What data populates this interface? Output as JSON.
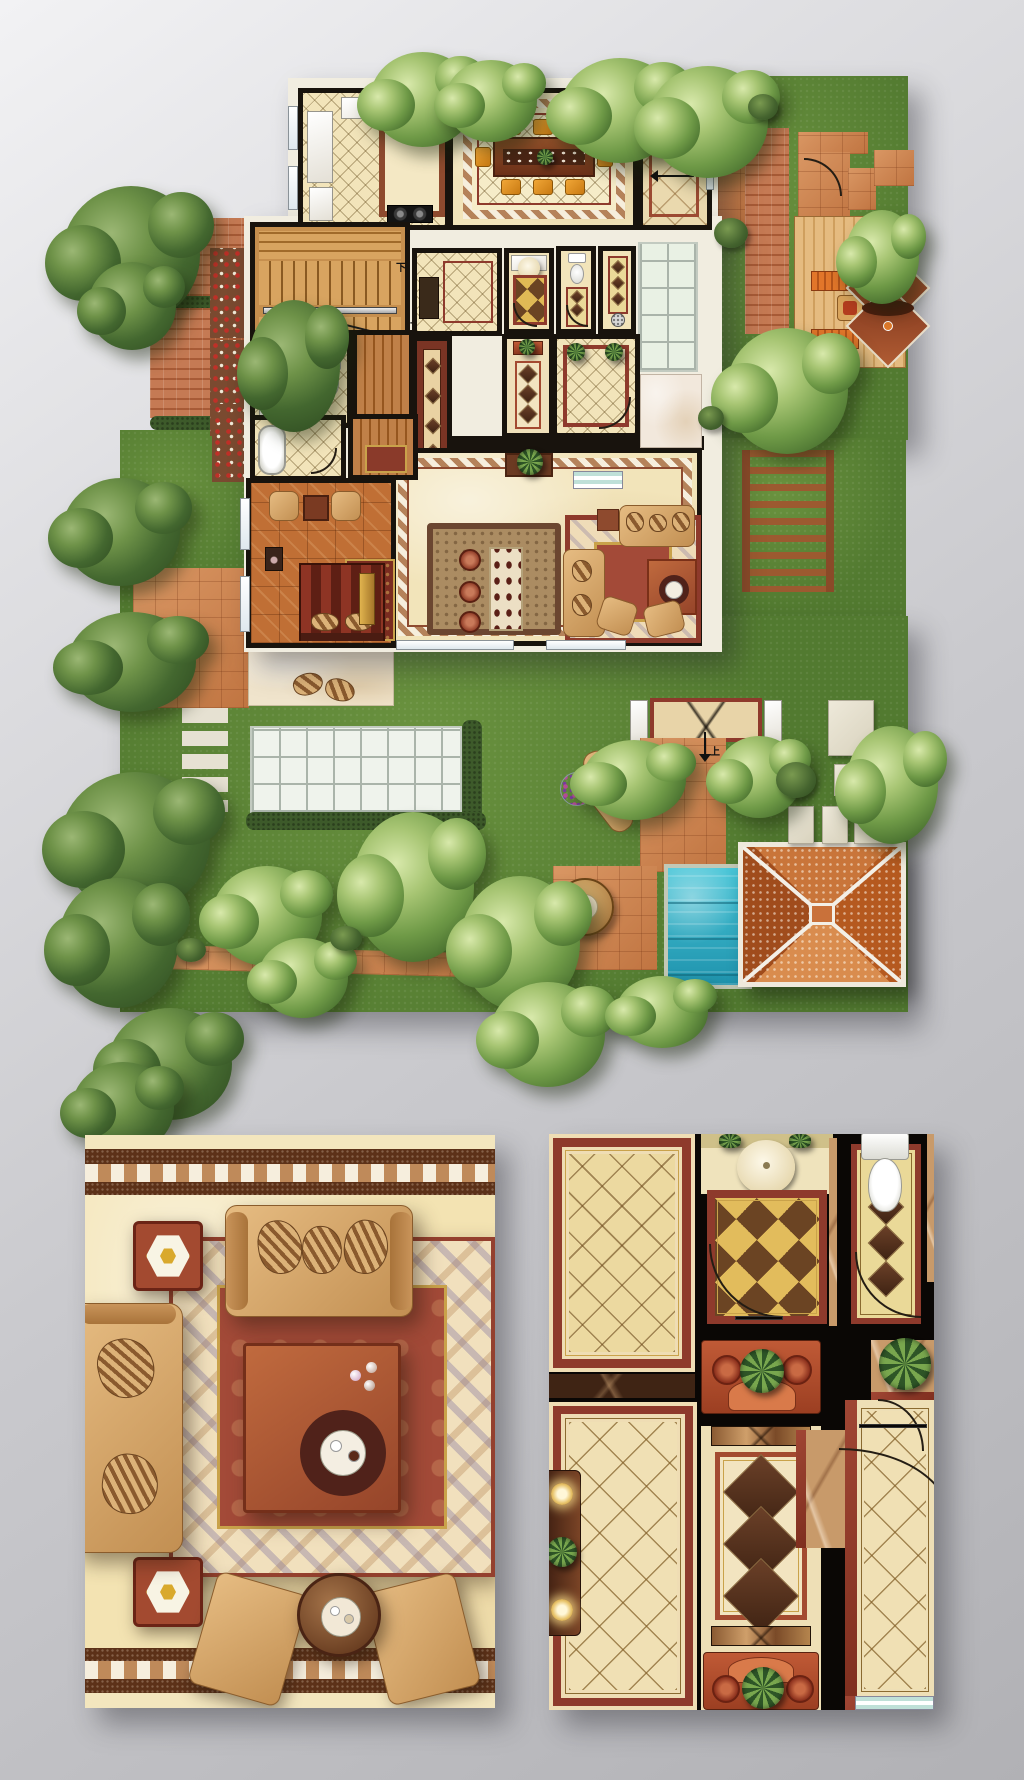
{
  "meta": {
    "title": "Villa ground-floor plan with landscaped garden and two interior detail enlargements",
    "style": "top-down architectural color rendering",
    "canvas": {
      "width": 1024,
      "height": 1780
    }
  },
  "palette": {
    "background_top": "#f2f2f4",
    "background_bottom": "#b1b1b5",
    "wall_black": "#18130d",
    "exterior_trim": "#f1ede0",
    "floor_cream": "#f2e4ba",
    "floor_gold_checker": "#e0b955",
    "marble_red": "#8e3a2c",
    "marble_dark_brown": "#3f2414",
    "carpet_red": "#a34a38",
    "carpet_cream": "#efdcb8",
    "checker_tan": "#bf8a5a",
    "checker_white": "#f6eedd",
    "parquet_wood": "#c06f35",
    "stair_wood": "#cd8c4b",
    "sofa_tan": "#d9a96e",
    "coffee_table": "#b05a36",
    "dining_chair_orange": "#e6921f",
    "lawn_green": "#527a30",
    "hedge_green": "#3d5a2a",
    "terracotta_patio": "#cd8049",
    "brick_path": "#bd6a42",
    "deck_wood": "#dcaf72",
    "bench_orange": "#cf6a28",
    "pavilion_tile": "#c76f34",
    "pavilion_ridge_white": "#f3efe6",
    "pagoda_roof": "#93442a",
    "pool_water": "#2fb4c8",
    "pool_coping": "#c2c8b6",
    "stepping_stone": "#e6e1d2",
    "glass_terrace": "#eff3ec",
    "flower_red": "#c03028",
    "plant_green": "#79a74e"
  },
  "plan": {
    "labels": {
      "stair_down": "下",
      "stair_up": "上",
      "entry_up": "上",
      "garden_step_up": "上"
    },
    "counts": {
      "dining_chairs": 8,
      "bar_stools": 3,
      "deck_benches": 2,
      "garden_loungers": 2,
      "left_stepping_stones": 5,
      "corridor_runner_diamonds": 3
    },
    "rooms": [
      "kitchen",
      "dining-room",
      "entry-corridor",
      "staircase",
      "bathroom",
      "walk-in-closet",
      "study",
      "powder-room",
      "wc",
      "shower-room",
      "sunroom",
      "entry-hall",
      "great-room",
      "bar-lounge",
      "bedroom",
      "master-bathroom",
      "dressing-room",
      "inner-corridor"
    ],
    "garden_features": [
      "swimming-pool",
      "tiled-pavilion",
      "timber-deck",
      "twin-pagoda-canopy",
      "pergola",
      "glass-roof-terrace",
      "brick-paths",
      "stepping-stones",
      "flower-border",
      "lawn",
      "trees",
      "lounge-chairs",
      "round-patio-table",
      "porch-landing"
    ]
  },
  "details": {
    "left": {
      "subject": "great-room sofa group enlargement",
      "items": [
        "checker-border-band",
        "diamond-marble-floor",
        "ornate-carpet",
        "three-seat-sofa",
        "chaise-sofa",
        "square-coffee-table",
        "round-serving-tray",
        "hexagon-lamp-end-tables",
        "armchairs",
        "round-side-table"
      ]
    },
    "right": {
      "subject": "hallway and bathroom enlargement",
      "items": [
        "diamond-tile-rooms",
        "powder-room-sink",
        "wc-toilet",
        "gold-checker-floor",
        "console-with-plant",
        "corridor-diamond-runner",
        "marble-column-capitals",
        "door-swings",
        "corner-plants",
        "sideboard-with-lamps"
      ]
    }
  }
}
